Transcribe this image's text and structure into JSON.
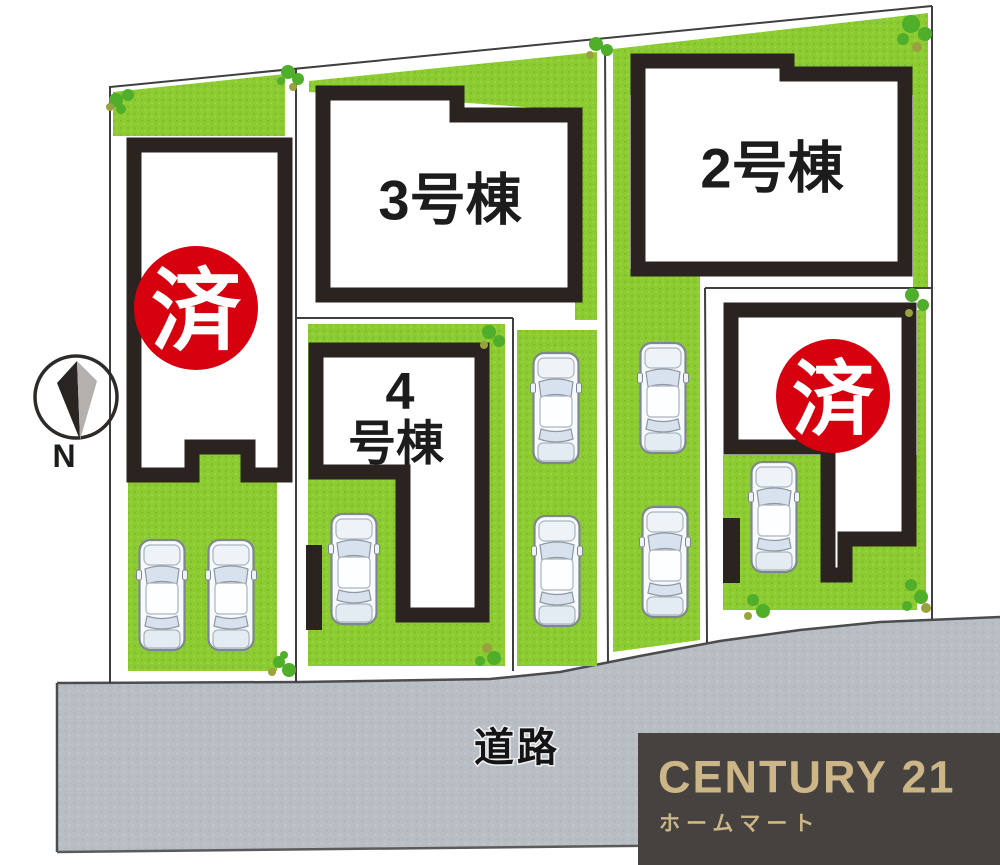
{
  "plan": {
    "title": "分譲地区画図",
    "north_label": "N",
    "road_label": "道路",
    "car_count": 8,
    "buildings": {
      "b2": {
        "label": "2号棟",
        "sold": false
      },
      "b3": {
        "label": "3号棟",
        "sold": false
      },
      "b4_line1": "4",
      "b4_line2": "号棟",
      "left_building": {
        "label": "",
        "sold": true
      },
      "right_building": {
        "label": "",
        "sold": true
      }
    },
    "stamps": {
      "sold_label": "済",
      "count": 2
    }
  },
  "brand": {
    "name": "CENTURY 21",
    "subtitle": "ホームマート",
    "text_color": "#ccb687",
    "bg_color": "#454240"
  },
  "colors": {
    "lawn_green": "#8ccb31",
    "building_border": "#2a2320",
    "road_gray": "#b8bec4",
    "stamp_red": "#d6000f",
    "lot_line": "#3f3f3f"
  }
}
